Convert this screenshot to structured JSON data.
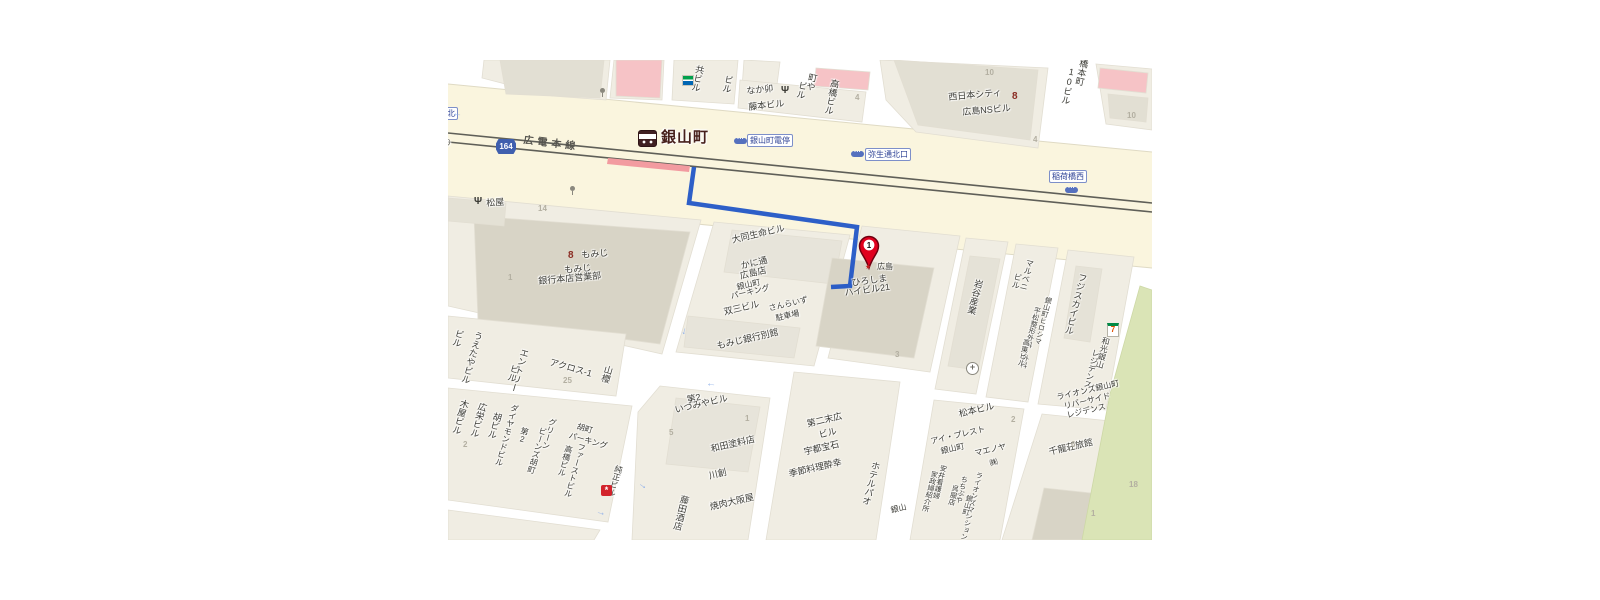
{
  "pin": {
    "label": "1"
  },
  "map": {
    "labels": [
      {
        "t": "共ビル",
        "x": 247,
        "y": 4,
        "r": 12,
        "v": 1
      },
      {
        "t": "ビル",
        "x": 276,
        "y": 14,
        "r": 12,
        "v": 1
      },
      {
        "t": "なか卯",
        "x": 298,
        "y": 27,
        "r": -6
      },
      {
        "t": "藤本ビル",
        "x": 300,
        "y": 43,
        "r": -6
      },
      {
        "t": "町や",
        "x": 360,
        "y": 12,
        "r": 12,
        "v": 1
      },
      {
        "t": "ビル",
        "x": 350,
        "y": 20,
        "r": 12,
        "v": 1
      },
      {
        "t": "高橋ビル",
        "x": 382,
        "y": 18,
        "r": 12,
        "v": 1
      },
      {
        "t": "4",
        "x": 407,
        "y": 34,
        "c": "num"
      },
      {
        "t": "西日本シティ",
        "x": 500,
        "y": 33,
        "r": -5
      },
      {
        "t": "広島NSビル",
        "x": 514,
        "y": 48,
        "r": -5
      },
      {
        "t": "10",
        "x": 537,
        "y": 9,
        "c": "num"
      },
      {
        "t": "4",
        "x": 585,
        "y": 76,
        "c": "num"
      },
      {
        "t": "橋本町",
        "x": 631,
        "y": -2,
        "r": 12,
        "v": 1
      },
      {
        "t": "10ビル",
        "x": 619,
        "y": 6,
        "r": 12,
        "v": 1
      },
      {
        "t": "10",
        "x": 679,
        "y": 52,
        "c": "num"
      },
      {
        "t": "通北",
        "x": -12,
        "y": 47,
        "c": "stop"
      },
      {
        "t": "通り",
        "x": -13,
        "y": 76,
        "r": 12,
        "c": "road"
      },
      {
        "t": "164",
        "x": 48,
        "y": 79,
        "c": "shield"
      },
      {
        "t": "広電本線",
        "x": 76,
        "y": 76,
        "r": 7,
        "c": "rail"
      },
      {
        "t": "銀山町",
        "x": 213,
        "y": 70,
        "c": "station"
      },
      {
        "t": "銀山町電停",
        "x": 299,
        "y": 74,
        "c": "stop"
      },
      {
        "t": "弥生通北口",
        "x": 417,
        "y": 88,
        "c": "stop"
      },
      {
        "t": "稲荷橋西",
        "x": 601,
        "y": 110,
        "c": "stop"
      },
      {
        "t": "松屋",
        "x": 38,
        "y": 139,
        "r": -4
      },
      {
        "t": "14",
        "x": 90,
        "y": 145,
        "c": "num"
      },
      {
        "t": "もみじ",
        "x": 133,
        "y": 191,
        "r": -5
      },
      {
        "t": "もみじ",
        "x": 116,
        "y": 206,
        "r": -5
      },
      {
        "t": "銀行本店営業部",
        "x": 90,
        "y": 217,
        "r": -5
      },
      {
        "t": "1",
        "x": 60,
        "y": 214,
        "c": "num"
      },
      {
        "t": "大同生命ビル",
        "x": 283,
        "y": 176,
        "r": -13
      },
      {
        "t": "かに通",
        "x": 292,
        "y": 202,
        "r": -13
      },
      {
        "t": "広島店",
        "x": 291,
        "y": 212,
        "r": -13
      },
      {
        "t": "銀山町",
        "x": 288,
        "y": 224,
        "r": -13,
        "s": 8
      },
      {
        "t": "パーキング",
        "x": 282,
        "y": 233,
        "r": -13,
        "s": 8
      },
      {
        "t": "双三ビル",
        "x": 275,
        "y": 248,
        "r": -13
      },
      {
        "t": "さんらいず",
        "x": 320,
        "y": 245,
        "r": -13,
        "s": 8
      },
      {
        "t": "駐車場",
        "x": 327,
        "y": 255,
        "r": -13,
        "s": 8
      },
      {
        "t": "もみじ銀行別館",
        "x": 268,
        "y": 282,
        "r": -13
      },
      {
        "t": "広島",
        "x": 429,
        "y": 203,
        "s": 8
      },
      {
        "t": "ひろしま",
        "x": 403,
        "y": 219,
        "r": -8
      },
      {
        "t": "ハイビル21",
        "x": 396,
        "y": 229,
        "r": -8
      },
      {
        "t": "3",
        "x": 447,
        "y": 291,
        "c": "num"
      },
      {
        "t": "岩谷産業",
        "x": 526,
        "y": 218,
        "r": 14,
        "v": 1
      },
      {
        "t": "マルベニ",
        "x": 578,
        "y": 198,
        "r": 14,
        "v": 1,
        "s": 8
      },
      {
        "t": "ビル",
        "x": 566,
        "y": 212,
        "r": 14,
        "v": 1,
        "s": 8
      },
      {
        "t": "銀山町ヒロシマ",
        "x": 597,
        "y": 236,
        "r": 14,
        "v": 1,
        "s": 7
      },
      {
        "t": "平松整形外科・外科",
        "x": 586,
        "y": 246,
        "r": 14,
        "v": 1,
        "s": 7
      },
      {
        "t": "高東ビル",
        "x": 575,
        "y": 278,
        "r": 14,
        "v": 1,
        "s": 7
      },
      {
        "t": "松本ビル",
        "x": 510,
        "y": 350,
        "r": -13
      },
      {
        "t": "2",
        "x": 563,
        "y": 356,
        "c": "num"
      },
      {
        "t": "フジスカイビル",
        "x": 630,
        "y": 212,
        "r": 14,
        "v": 1
      },
      {
        "t": "和光銀山",
        "x": 654,
        "y": 276,
        "r": 14,
        "v": 1,
        "s": 8
      },
      {
        "t": "レジデンス",
        "x": 644,
        "y": 288,
        "r": 14,
        "v": 1,
        "s": 8
      },
      {
        "t": "ライオンズ銀山町",
        "x": 608,
        "y": 334,
        "r": -13,
        "s": 8
      },
      {
        "t": "リバーサイド",
        "x": 615,
        "y": 343,
        "r": -13,
        "s": 8
      },
      {
        "t": "レジデンス",
        "x": 618,
        "y": 352,
        "r": -13,
        "s": 8
      },
      {
        "t": "千龍荘旅館",
        "x": 600,
        "y": 388,
        "r": -13
      },
      {
        "t": "6",
        "x": 623,
        "y": 381,
        "c": "num"
      },
      {
        "t": "1",
        "x": 643,
        "y": 450,
        "c": "num"
      },
      {
        "t": "18",
        "x": 681,
        "y": 421,
        "c": "num"
      },
      {
        "t": "アイ・プレスト",
        "x": 482,
        "y": 378,
        "r": -13,
        "s": 8
      },
      {
        "t": "銀山町",
        "x": 492,
        "y": 388,
        "r": -13,
        "s": 8
      },
      {
        "t": "マエノヤ",
        "x": 526,
        "y": 390,
        "r": -13,
        "s": 8
      },
      {
        "t": "㈱",
        "x": 541,
        "y": 400,
        "r": -13,
        "s": 8
      },
      {
        "t": "安井看護婦",
        "x": 492,
        "y": 404,
        "r": 14,
        "v": 1,
        "s": 7
      },
      {
        "t": "家政婦紹介所",
        "x": 483,
        "y": 410,
        "r": 14,
        "v": 1,
        "s": 7
      },
      {
        "t": "ちちぶや",
        "x": 513,
        "y": 415,
        "r": 14,
        "v": 1,
        "s": 7
      },
      {
        "t": "呉服店",
        "x": 504,
        "y": 424,
        "r": 14,
        "v": 1,
        "s": 7
      },
      {
        "t": "ライオンズマンション",
        "x": 528,
        "y": 411,
        "r": 14,
        "v": 1,
        "s": 7
      },
      {
        "t": "銀山町",
        "x": 518,
        "y": 434,
        "r": 14,
        "v": 1,
        "s": 7
      },
      {
        "t": "銀山",
        "x": 442,
        "y": 447,
        "r": -13,
        "s": 8
      },
      {
        "t": "ホテルパオ",
        "x": 423,
        "y": 400,
        "r": 14,
        "v": 1
      },
      {
        "t": "第二末広",
        "x": 358,
        "y": 360,
        "r": -13
      },
      {
        "t": "ビル",
        "x": 370,
        "y": 371,
        "r": -13
      },
      {
        "t": "宇都宝石",
        "x": 355,
        "y": 388,
        "r": -13
      },
      {
        "t": "季節料理酔幸",
        "x": 340,
        "y": 410,
        "r": -13
      },
      {
        "t": "第2",
        "x": 238,
        "y": 336,
        "r": -13
      },
      {
        "t": "いづみやビル",
        "x": 226,
        "y": 346,
        "r": -13
      },
      {
        "t": "5",
        "x": 221,
        "y": 369,
        "c": "num"
      },
      {
        "t": "1",
        "x": 297,
        "y": 355,
        "c": "num"
      },
      {
        "t": "和田塗料店",
        "x": 262,
        "y": 385,
        "r": -13
      },
      {
        "t": "川創",
        "x": 260,
        "y": 412,
        "r": -13
      },
      {
        "t": "藤田酒店",
        "x": 232,
        "y": 434,
        "r": 14,
        "v": 1
      },
      {
        "t": "焼肉大阪屋",
        "x": 261,
        "y": 443,
        "r": -13
      },
      {
        "t": "ビル",
        "x": 7,
        "y": 268,
        "r": 16,
        "v": 1
      },
      {
        "t": "うえたやビル",
        "x": 26,
        "y": 270,
        "r": 16,
        "v": 1
      },
      {
        "t": "エントリー",
        "x": 72,
        "y": 287,
        "r": 16,
        "v": 1
      },
      {
        "t": "ビル",
        "x": 62,
        "y": 303,
        "r": 16,
        "v": 1
      },
      {
        "t": "アクロス-1",
        "x": 103,
        "y": 298,
        "r": 16
      },
      {
        "t": "25",
        "x": 115,
        "y": 317,
        "c": "num"
      },
      {
        "t": "山櫻",
        "x": 156,
        "y": 304,
        "r": 16,
        "v": 1
      },
      {
        "t": "木屋ビル",
        "x": 12,
        "y": 338,
        "r": 16,
        "v": 1
      },
      {
        "t": "広栄ビル",
        "x": 30,
        "y": 341,
        "r": 16,
        "v": 1
      },
      {
        "t": "2",
        "x": 15,
        "y": 381,
        "c": "num"
      },
      {
        "t": "胡ビル",
        "x": 45,
        "y": 351,
        "r": 16,
        "v": 1
      },
      {
        "t": "ダイヤモンドビル",
        "x": 63,
        "y": 343,
        "r": 16,
        "v": 1,
        "s": 8
      },
      {
        "t": "第2",
        "x": 73,
        "y": 366,
        "r": 16,
        "v": 1,
        "s": 8
      },
      {
        "t": "グリーン",
        "x": 101,
        "y": 357,
        "r": 16,
        "v": 1,
        "s": 8
      },
      {
        "t": "ビーンズ胡町",
        "x": 91,
        "y": 366,
        "r": 16,
        "v": 1,
        "s": 8
      },
      {
        "t": "胡町",
        "x": 130,
        "y": 363,
        "r": 16,
        "s": 8
      },
      {
        "t": "パーキング",
        "x": 122,
        "y": 372,
        "r": 16,
        "s": 8
      },
      {
        "t": "高橋ビル",
        "x": 117,
        "y": 384,
        "r": 16,
        "v": 1,
        "s": 8
      },
      {
        "t": "ファーストビル",
        "x": 130,
        "y": 382,
        "r": 16,
        "v": 1,
        "s": 8
      },
      {
        "t": "純正ビル",
        "x": 167,
        "y": 404,
        "r": 16,
        "v": 1,
        "s": 8
      }
    ],
    "icons": [
      {
        "name": "familymart-icon",
        "x": 234,
        "y": 15
      },
      {
        "name": "restaurant-icon",
        "x": 333,
        "y": 25,
        "g": "Ψ"
      },
      {
        "name": "restaurant-icon",
        "x": 26,
        "y": 136,
        "g": "Ψ"
      },
      {
        "name": "bank-icon",
        "x": 564,
        "y": 31,
        "g": "8"
      },
      {
        "name": "bank-icon",
        "x": 120,
        "y": 190,
        "g": "8"
      },
      {
        "name": "station-icon",
        "x": 190,
        "y": 70
      },
      {
        "name": "tram-icon",
        "x": 286,
        "y": 78,
        "g": "···"
      },
      {
        "name": "tram-icon",
        "x": 403,
        "y": 91,
        "g": "···"
      },
      {
        "name": "tram-icon",
        "x": 617,
        "y": 127,
        "g": "···"
      },
      {
        "name": "signal-icon",
        "x": 152,
        "y": 28
      },
      {
        "name": "signal-icon",
        "x": 122,
        "y": 126
      },
      {
        "name": "company-icon",
        "x": 417,
        "y": 203,
        "g": "★"
      },
      {
        "name": "hospital-icon",
        "x": 518,
        "y": 302,
        "g": "+"
      },
      {
        "name": "seveneleven-icon",
        "x": 659,
        "y": 263,
        "g": "7"
      },
      {
        "name": "redpoi-icon",
        "x": 153,
        "y": 425,
        "g": "*"
      },
      {
        "name": "arrow-icon",
        "x": 232,
        "y": 266,
        "r": 105,
        "g": "→"
      },
      {
        "name": "arrow-icon",
        "x": 258,
        "y": 320,
        "r": 185,
        "g": "→"
      },
      {
        "name": "arrow-icon",
        "x": 190,
        "y": 420,
        "r": 35,
        "g": "→"
      },
      {
        "name": "arrow-icon",
        "x": 148,
        "y": 447,
        "r": 15,
        "g": "→"
      },
      {
        "name": "arrow-icon",
        "x": 4,
        "y": 50,
        "r": 185,
        "g": "→"
      }
    ]
  }
}
